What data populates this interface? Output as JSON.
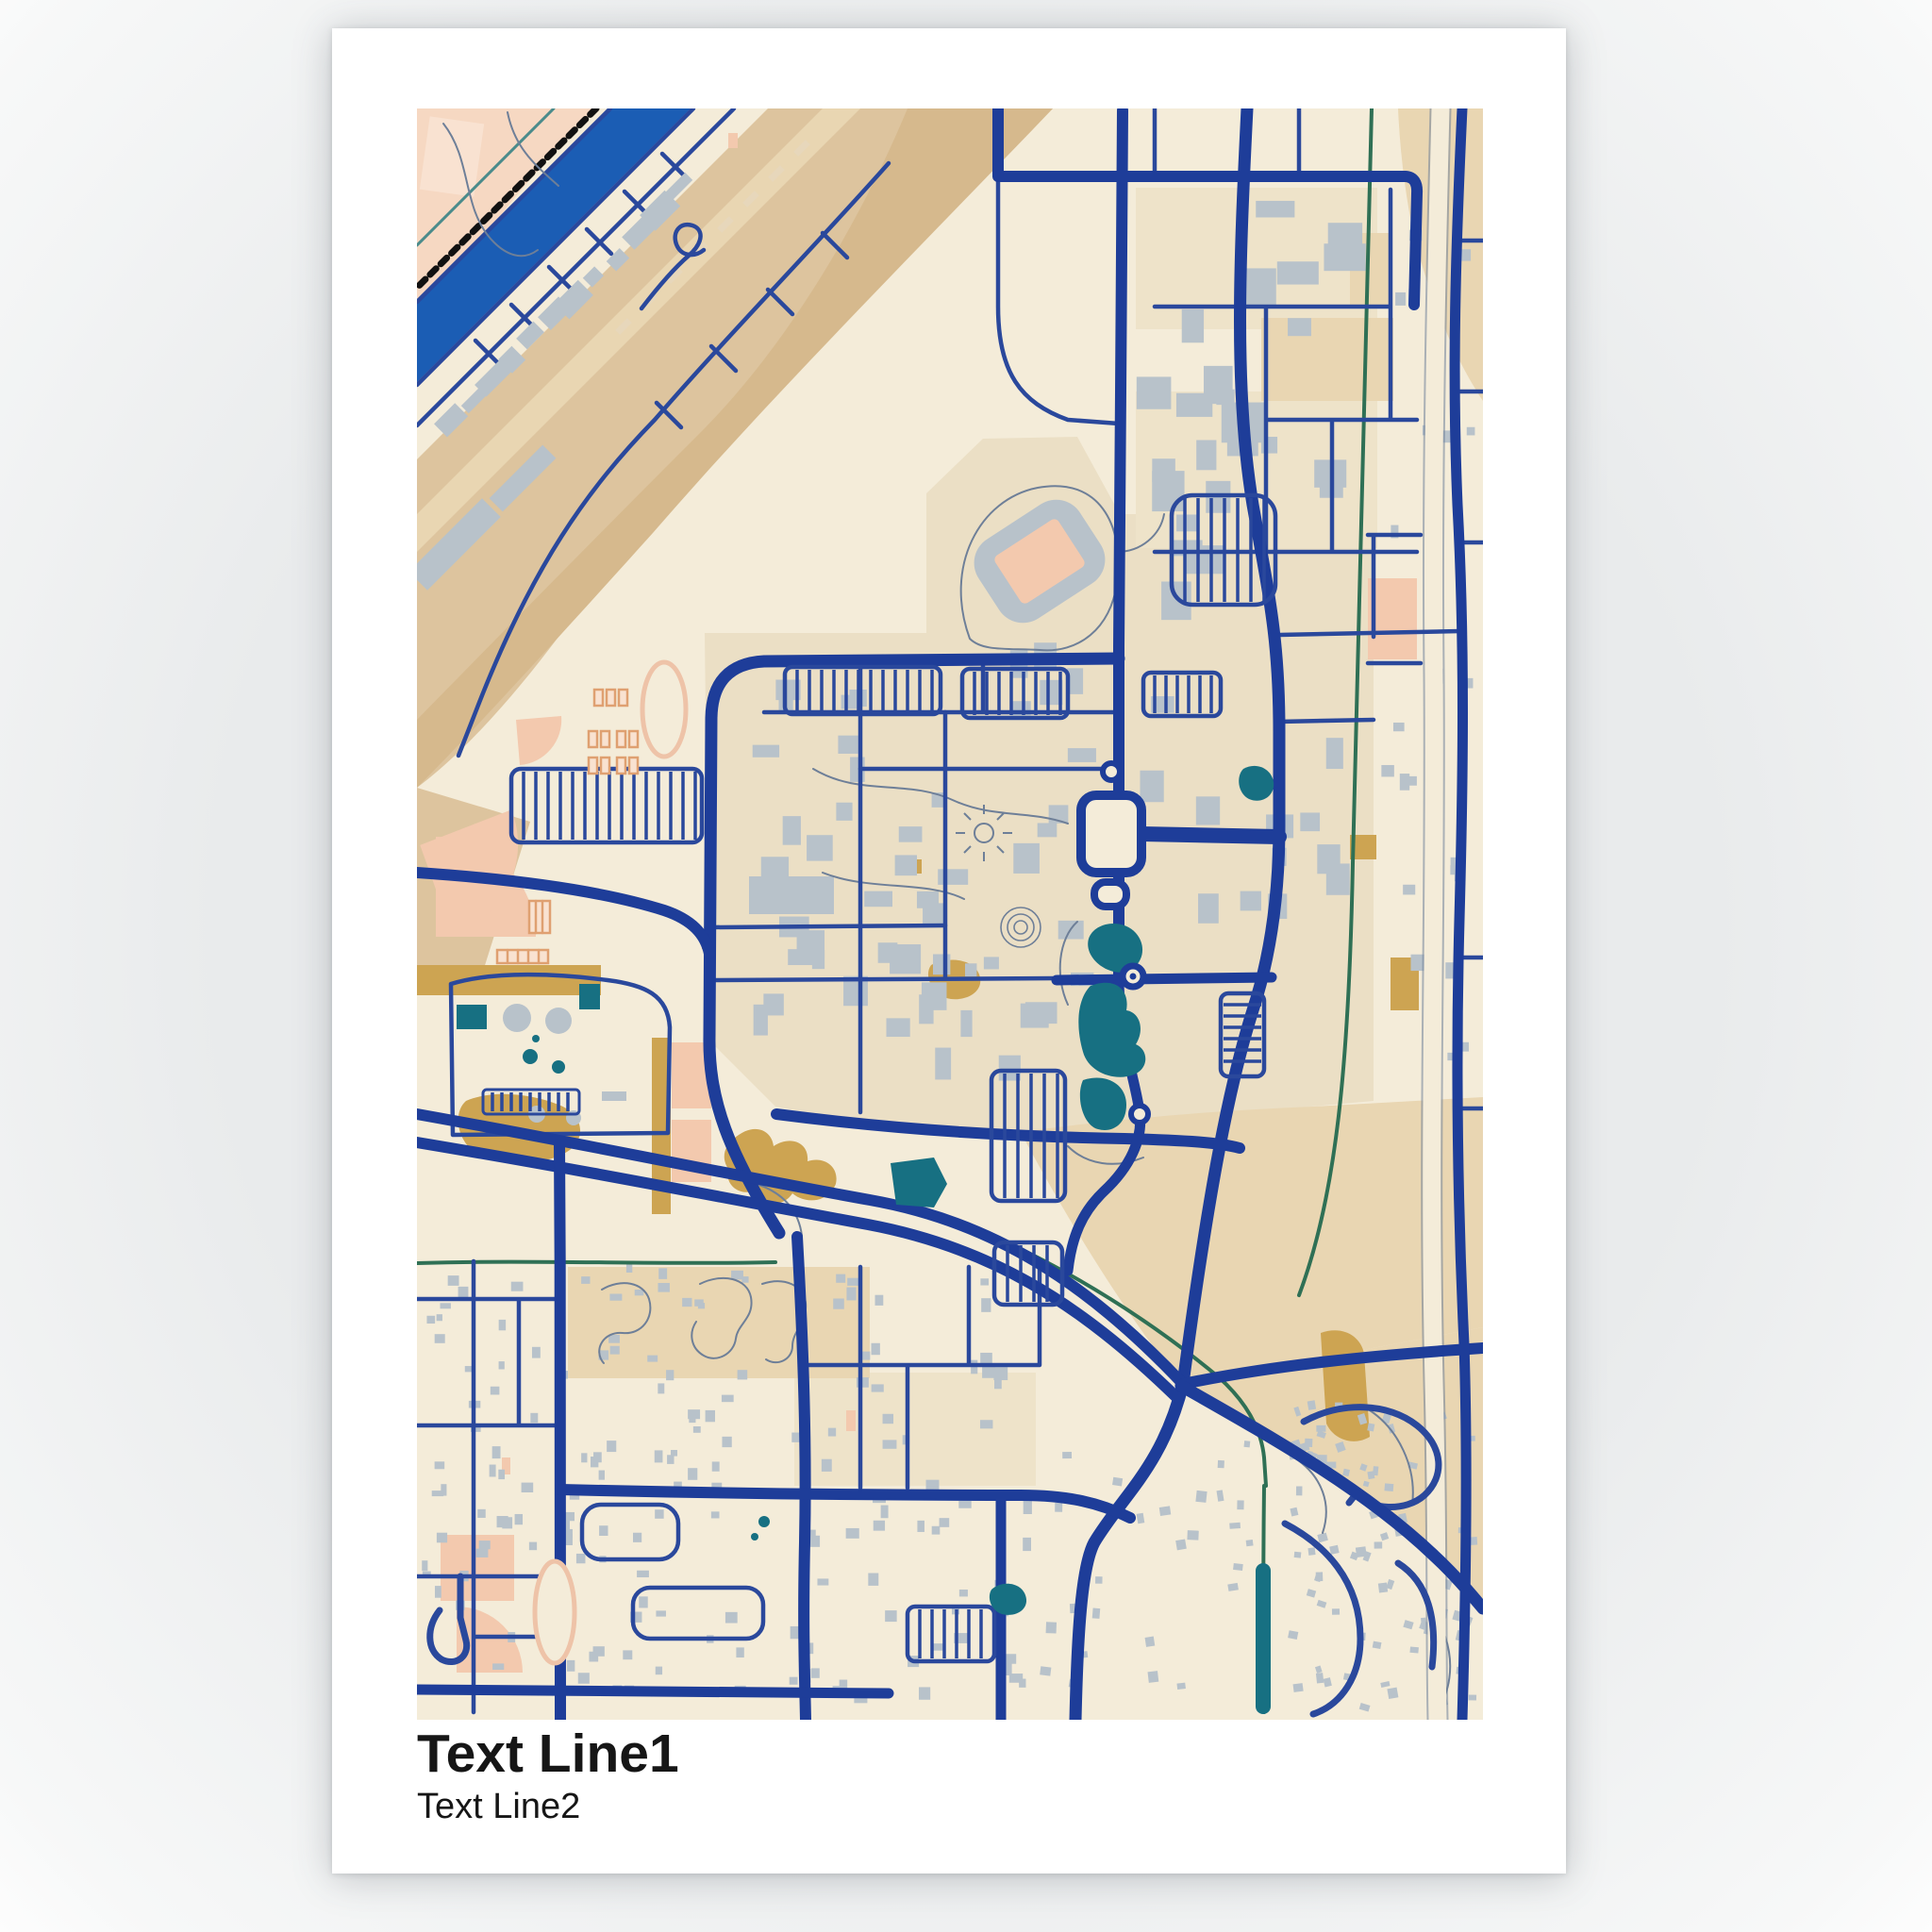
{
  "poster": {
    "title_line1": "Text Line1",
    "title_line2": "Text Line2"
  },
  "palette": {
    "paper": "#ffffff",
    "text": "#161616",
    "cream": "#f4ecd9",
    "cream2": "#eee3c9",
    "campus": "#ebdfc5",
    "tan": "#ddc49e",
    "tanLight": "#e9d6b2",
    "tanDark": "#d6b98d",
    "mustard": "#cda452",
    "pink": "#f6d8c2",
    "pinkDeep": "#f3c9ae",
    "pinkLine": "#eec3a8",
    "pinkPale": "#f9e2d1",
    "orange": "#dfa071",
    "gray": "#b8c2ca",
    "navy": "#1e3d99",
    "navyThin": "#2a489c",
    "slate": "#6e7f98",
    "canal": "#1b5db4",
    "teal": "#177082",
    "green": "#2f7055",
    "railway": "#111111"
  },
  "map": {
    "features": [
      "cream-basemap",
      "pink-recreation-zone",
      "rail-corridor-tan-band",
      "railway-dashed-line",
      "blue-canal",
      "campus-loop-road",
      "arterial-roads",
      "divided-highway",
      "residential-streets",
      "parking-lot-combs",
      "gray-buildings",
      "stadium",
      "running-tracks",
      "baseball-fields",
      "tennis-courts",
      "teal-ponds",
      "green-creeks",
      "freeway-band",
      "water-treatment-plant",
      "roundabouts",
      "central-plaza",
      "cul-de-sac-loops"
    ]
  }
}
